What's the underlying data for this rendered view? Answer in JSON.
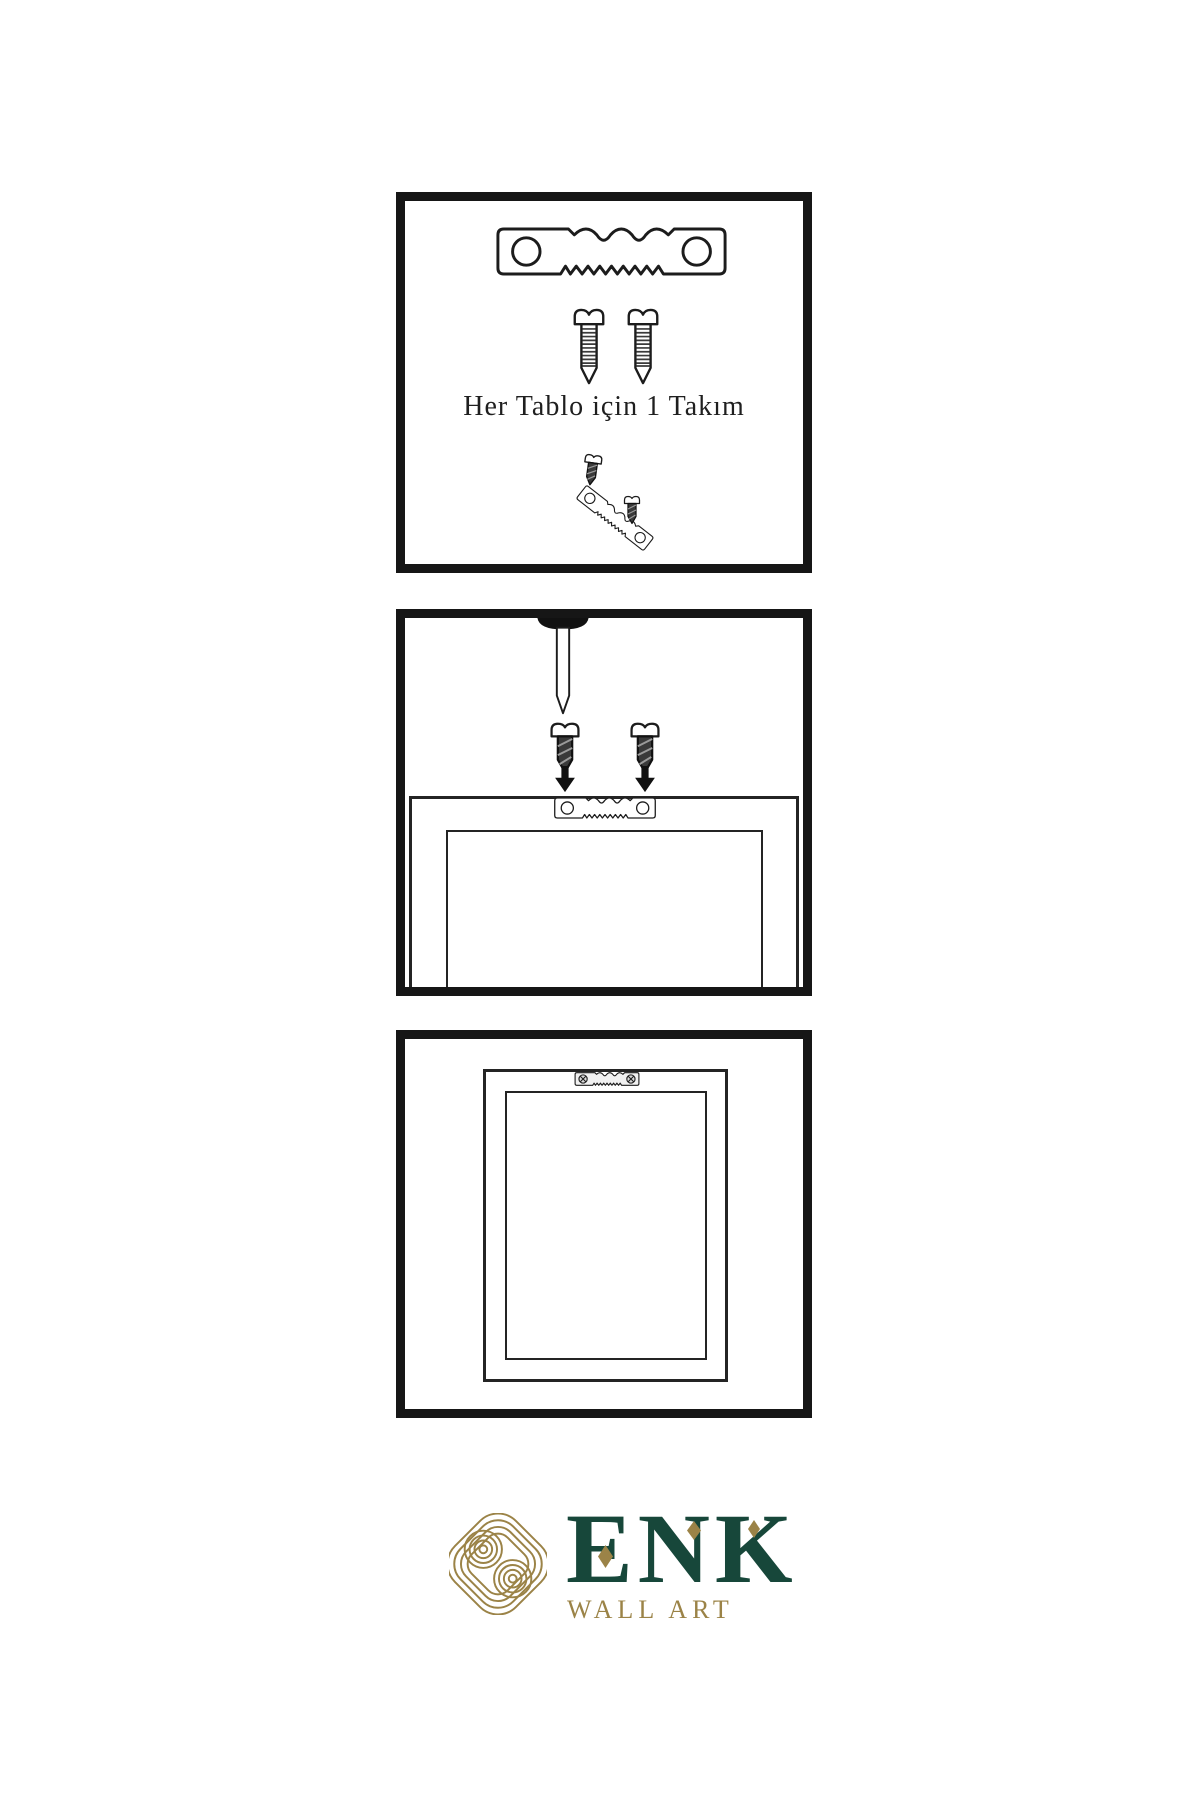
{
  "page": {
    "background": "#ffffff"
  },
  "colors": {
    "ink": "#1c1c1c",
    "logo_green": "#17473a",
    "logo_gold": "#9b8347"
  },
  "panels": [
    {
      "id": 1,
      "caption": "Her Tablo için 1 Takım",
      "icons": [
        "sawtooth-hanger-icon",
        "screw-icon",
        "screw-icon",
        "screw-icon",
        "tilted-sawtooth-hanger-icon",
        "screw-icon"
      ]
    },
    {
      "id": 2,
      "caption": "",
      "icons": [
        "nail-icon",
        "screw-icon",
        "screw-icon",
        "down-arrow-icon",
        "down-arrow-icon",
        "sawtooth-hanger-icon",
        "frame-back-outline"
      ]
    },
    {
      "id": 3,
      "caption": "",
      "icons": [
        "mounted-sawtooth-hanger-icon",
        "hanging-frame-outline"
      ]
    }
  ],
  "logo": {
    "brand": "ENK",
    "subtitle": "WALL ART",
    "icon": "interlaced-knot-icon"
  }
}
